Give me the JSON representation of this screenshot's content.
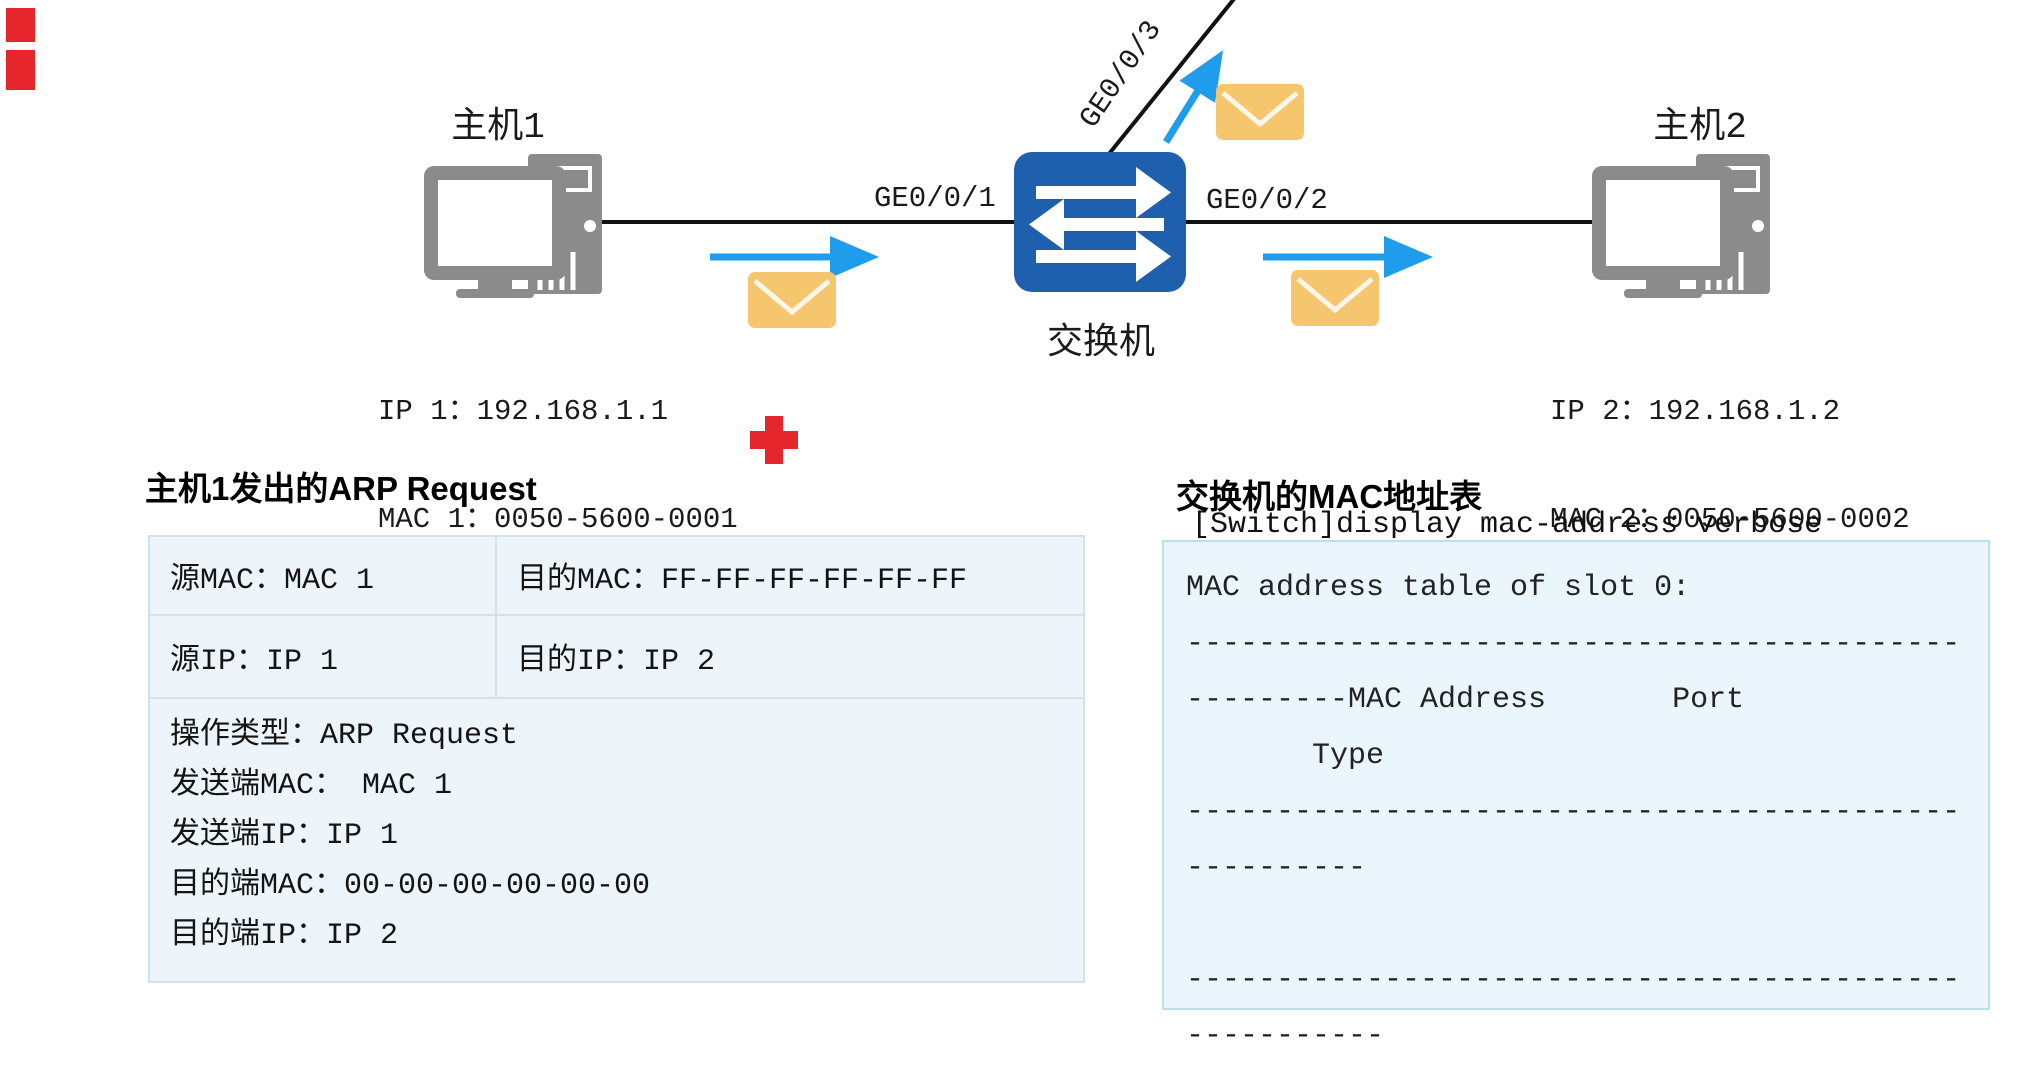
{
  "diagram": {
    "host1": {
      "label": "主机1",
      "ip": "IP 1：192.168.1.1",
      "mac": "MAC 1：0050-5600-0001"
    },
    "host2": {
      "label": "主机2",
      "ip": "IP 2：192.168.1.2",
      "mac": "MAC 2：0050-5600-0002"
    },
    "switch": {
      "label": "交换机"
    },
    "ports": {
      "p1": "GE0/0/1",
      "p2": "GE0/0/2",
      "p3": "GE0/0/3"
    }
  },
  "arp_request": {
    "title": "主机1发出的ARP Request",
    "row1": {
      "src_mac": "源MAC：MAC 1",
      "dst_mac": "目的MAC：FF-FF-FF-FF-FF-FF"
    },
    "row2": {
      "src_ip": "源IP：IP 1",
      "dst_ip": "目的IP：IP 2"
    },
    "details": [
      "操作类型：ARP Request",
      "发送端MAC： MAC 1",
      "发送端IP：IP 1",
      "目的端MAC：00-00-00-00-00-00",
      "目的端IP：IP 2"
    ]
  },
  "mac_table": {
    "title": "交换机的MAC地址表",
    "command": "[Switch]display mac-address verbose",
    "console_lines": [
      "MAC address table of slot 0:",
      "-------------------------------------------",
      "---------MAC Address       Port",
      "       Type",
      "-------------------------------------------",
      "----------",
      "",
      "-------------------------------------------",
      "-----------"
    ]
  },
  "colors": {
    "switch_blue": "#1e5fae",
    "arrow_blue": "#1f9ceb",
    "envelope_orange": "#f6c66f",
    "marker_red": "#e5262d",
    "table_bg": "#edf5fa",
    "console_bg": "#eaf6fb",
    "console_border": "#b9e0ef"
  }
}
